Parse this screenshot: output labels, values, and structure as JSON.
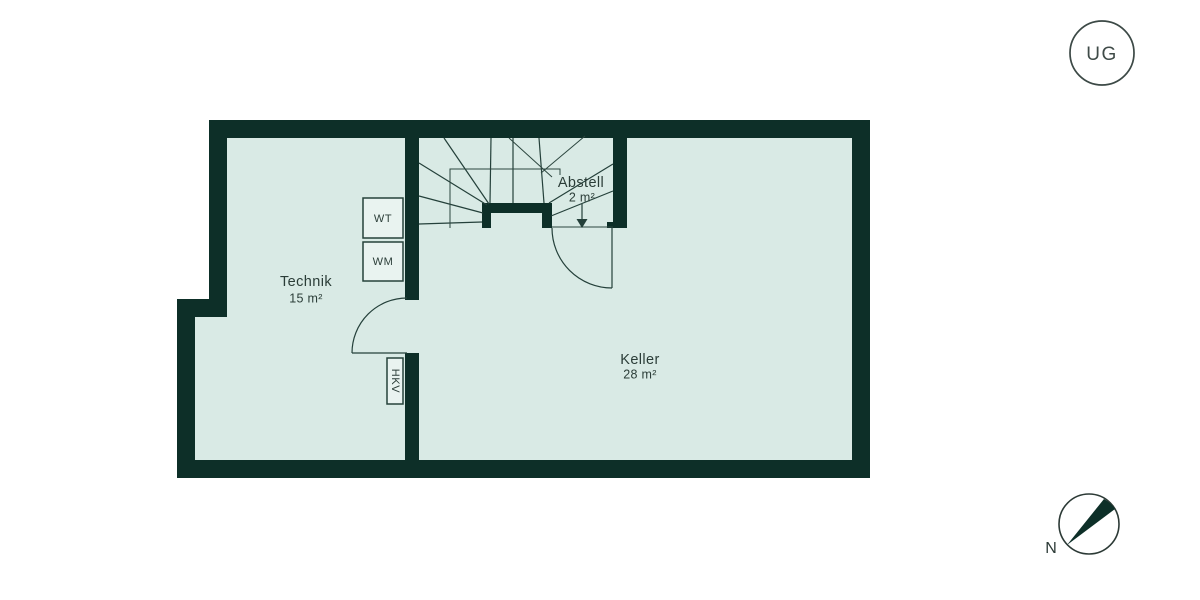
{
  "floor_plan": {
    "level_badge": {
      "label": "UG"
    },
    "compass": {
      "label": "N"
    },
    "rooms": {
      "technik": {
        "name": "Technik",
        "area": "15 m²"
      },
      "keller": {
        "name": "Keller",
        "area": "28 m²"
      },
      "abstell": {
        "name": "Abstell",
        "area": "2 m²"
      }
    },
    "fixtures": {
      "wt": {
        "label": "WT"
      },
      "wm": {
        "label": "WM"
      },
      "hkv": {
        "label": "HKV"
      }
    }
  },
  "colors": {
    "background": "#ffffff",
    "wall": "#0d2f28",
    "floor_fill": "#d9eae5",
    "line": "#24403a",
    "text": "#2b3d38"
  }
}
